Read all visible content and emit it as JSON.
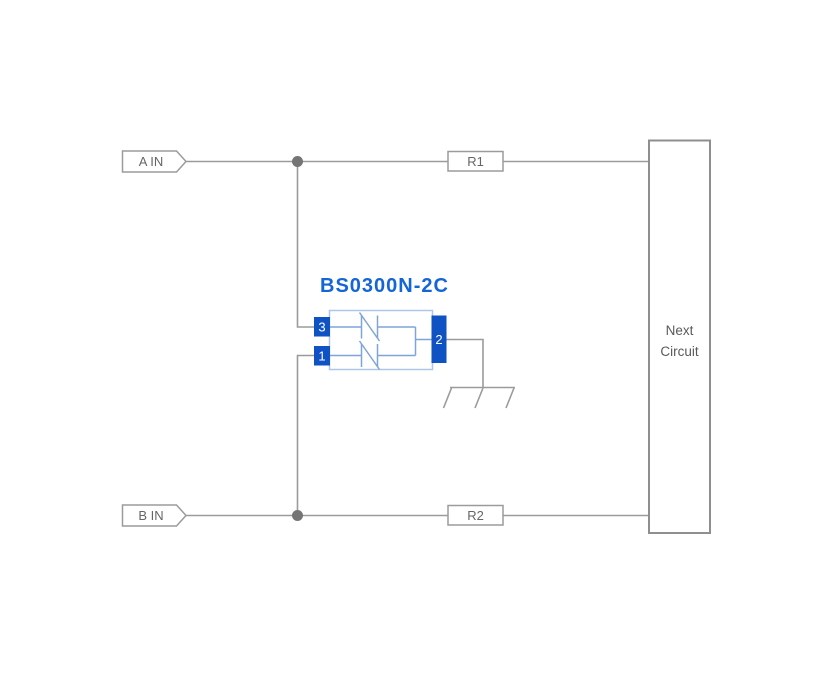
{
  "diagram": {
    "component": {
      "name": "BS0300N-2C",
      "pins": {
        "top_left": "3",
        "bottom_left": "1",
        "right": "2"
      }
    },
    "inputs": {
      "a": "A IN",
      "b": "B IN"
    },
    "resistors": {
      "r1": "R1",
      "r2": "R2"
    },
    "next_circuit": {
      "lines": [
        "Next",
        "Circuit"
      ]
    },
    "icons": {
      "junction": "junction-dot",
      "ground": "chassis-ground-icon",
      "input_flag": "input-arrow-flag"
    },
    "colors": {
      "background": "#ffffff",
      "wire": "#9b9b9b",
      "junction": "#757575",
      "box_border": "#9b9b9b",
      "label_text": "#666666",
      "next_circuit_border": "#8f8f8f",
      "next_circuit_text": "#5a5a5a",
      "title_blue": "#1465d6",
      "pin_blue": "#0e52c4",
      "component_outline": "#aec7e8",
      "diode_stroke": "#7fa5d8"
    }
  }
}
